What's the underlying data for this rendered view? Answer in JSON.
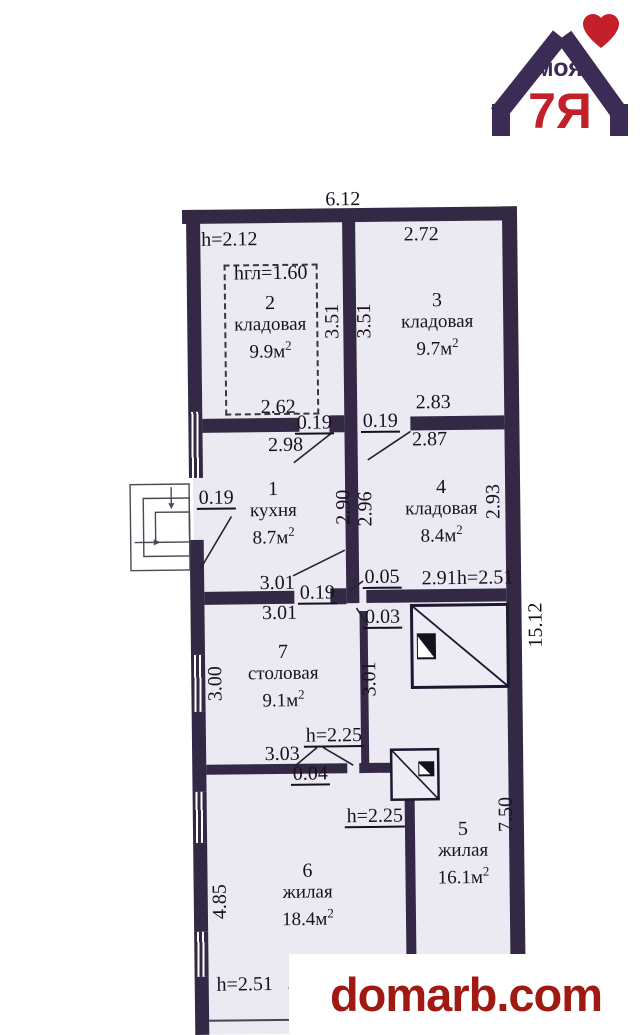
{
  "site_logo": {
    "word_top": "моя",
    "word_bottom": "7Я",
    "heart_icon": "heart",
    "primary_color": "#3b2c56",
    "accent_color": "#c3202a"
  },
  "watermark": {
    "text": "domarb.com",
    "color": "#9e1a13"
  },
  "plan": {
    "colors": {
      "wall": "#332945",
      "floor": "#ebe9f2",
      "line": "#241f33"
    },
    "area_superscript": "2",
    "overall_width_label": "6.12",
    "overall_side_label": "15.12",
    "rooms": [
      {
        "number": "2",
        "name": "кладовая",
        "area": "9.9м",
        "x": 269,
        "y": 294
      },
      {
        "number": "3",
        "name": "кладовая",
        "area": "9.7м",
        "x": 436,
        "y": 293
      },
      {
        "number": "1",
        "name": "кухня",
        "area": "8.7м",
        "x": 270,
        "y": 480
      },
      {
        "number": "4",
        "name": "кладовая",
        "area": "8.4м",
        "x": 438,
        "y": 480
      },
      {
        "number": "7",
        "name": "столовая",
        "area": "9.1м",
        "x": 278,
        "y": 643
      },
      {
        "number": "5",
        "name": "жилая",
        "area": "16.1м",
        "x": 456,
        "y": 822
      },
      {
        "number": "6",
        "name": "жилая",
        "area": "18.4м",
        "x": 300,
        "y": 862
      }
    ],
    "dim_labels": [
      {
        "text": "6.12",
        "x": 343,
        "y": 201
      },
      {
        "text": "h=2.12",
        "x": 229,
        "y": 240
      },
      {
        "text": "hгл=1.60",
        "x": 270,
        "y": 274
      },
      {
        "text": "2.72",
        "x": 421,
        "y": 237
      },
      {
        "text": "2.62",
        "x": 276,
        "y": 408
      },
      {
        "text": "0.19",
        "x": 312,
        "y": 425,
        "ul": true
      },
      {
        "text": "0.19",
        "x": 378,
        "y": 424,
        "ul": true
      },
      {
        "text": "2.83",
        "x": 431,
        "y": 405
      },
      {
        "text": "2.98",
        "x": 283,
        "y": 446
      },
      {
        "text": "2.87",
        "x": 427,
        "y": 442
      },
      {
        "text": "0.19",
        "x": 213,
        "y": 499,
        "ul": true
      },
      {
        "text": "3.01",
        "x": 273,
        "y": 584
      },
      {
        "text": "0.19",
        "x": 313,
        "y": 595,
        "ul": true
      },
      {
        "text": "0.05",
        "x": 378,
        "y": 580,
        "ul": true
      },
      {
        "text": "2.91",
        "x": 435,
        "y": 581
      },
      {
        "text": "h=2.51",
        "x": 481,
        "y": 581
      },
      {
        "text": "3.01",
        "x": 275,
        "y": 614
      },
      {
        "text": "0.03",
        "x": 378,
        "y": 620,
        "ul": true
      },
      {
        "text": "3.03",
        "x": 276,
        "y": 755
      },
      {
        "text": "h=2.25",
        "x": 328,
        "y": 738,
        "ul": true
      },
      {
        "text": "0.04",
        "x": 304,
        "y": 776,
        "ul": true
      },
      {
        "text": "h=2.25",
        "x": 368,
        "y": 819,
        "ul": true
      },
      {
        "text": "h=2.51",
        "x": 236,
        "y": 985
      },
      {
        "text": "3",
        "x": 284,
        "y": 985
      },
      {
        "text": "3.51",
        "x": 331,
        "y": 323,
        "rot": 270
      },
      {
        "text": "3.51",
        "x": 363,
        "y": 323,
        "rot": 270
      },
      {
        "text": "2.90",
        "x": 340,
        "y": 509,
        "rot": 270
      },
      {
        "text": "2.96",
        "x": 362,
        "y": 511,
        "rot": 270
      },
      {
        "text": "2.93",
        "x": 490,
        "y": 505,
        "rot": 270
      },
      {
        "text": "15.12",
        "x": 531,
        "y": 629,
        "rot": 270
      },
      {
        "text": "3.00",
        "x": 210,
        "y": 684,
        "rot": 270
      },
      {
        "text": "3.01",
        "x": 364,
        "y": 681,
        "rot": 270
      },
      {
        "text": "7.50",
        "x": 499,
        "y": 818,
        "rot": 270
      },
      {
        "text": "4.85",
        "x": 212,
        "y": 902,
        "rot": 270
      }
    ]
  }
}
